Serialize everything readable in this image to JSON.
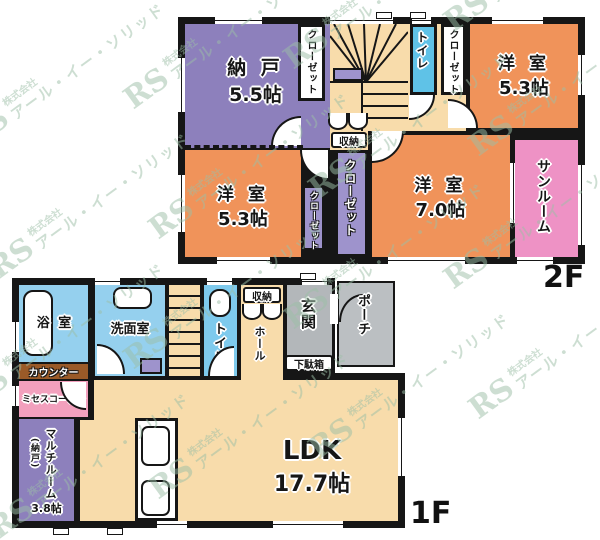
{
  "watermark": {
    "logo": "RS",
    "company": "株式会社",
    "name": "アール・イー・ソリッド"
  },
  "floor2": {
    "label": "2F",
    "nando_name": "納 戸",
    "nando_size": "5.5帖",
    "closet": "クローゼット",
    "toilet": "トイレ",
    "room_tr_name": "洋 室",
    "room_tr_size": "5.3帖",
    "room_bl_name": "洋 室",
    "room_bl_size": "5.3帖",
    "room_r_name": "洋 室",
    "room_r_size": "7.0帖",
    "sunroom": "サンルーム",
    "shuno": "収納"
  },
  "floor1": {
    "label": "1F",
    "bathroom": "浴 室",
    "washroom": "洗面室",
    "toilet": "トイレ",
    "shuno": "収納",
    "hall": "ホール",
    "genkan": "玄関",
    "getabako": "下駄箱",
    "porch": "ポーチ",
    "counter": "カウンター",
    "mrs": "ミセスコーナー",
    "multi_name": "マルチルーム",
    "multi_sub": "(納戸)",
    "multi_size": "3.8帖",
    "ldk_name": "LDK",
    "ldk_size": "17.7帖"
  }
}
